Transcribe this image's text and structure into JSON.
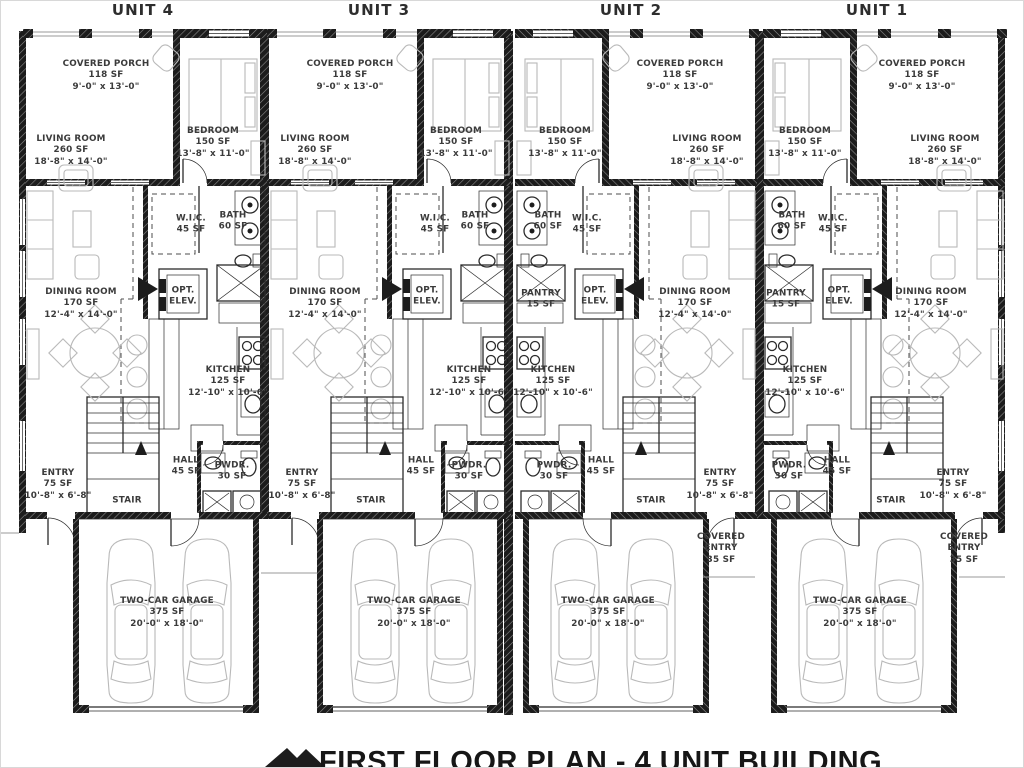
{
  "plan_title": "FIRST FLOOR PLAN - 4 UNIT BUILDING",
  "units": [
    {
      "name": "UNIT 4"
    },
    {
      "name": "UNIT 3"
    },
    {
      "name": "UNIT 2"
    },
    {
      "name": "UNIT 1"
    }
  ],
  "rooms": {
    "covered_porch": "COVERED PORCH\n118 SF\n9'-0\" x 13'-0\"",
    "living_room": "LIVING ROOM\n260 SF\n18'-8\" x 14'-0\"",
    "bedroom": "BEDROOM\n150 SF\n13'-8\" x 11'-0\"",
    "wic": "W.I.C.\n45 SF",
    "bath": "BATH\n60 SF",
    "opt_elev": "OPT.\nELEV.",
    "dining_room": "DINING ROOM\n170 SF\n12'-4\" x 14'-0\"",
    "kitchen": "KITCHEN\n125 SF\n12'-10\" x 10'-6\"",
    "pantry": "PANTRY\n15 SF",
    "hall": "HALL\n45 SF",
    "pwdr": "PWDR.\n30 SF",
    "entry": "ENTRY\n75 SF\n10'-8\" x 6'-8\"",
    "stair": "STAIR",
    "garage": "TWO-CAR GARAGE\n375 SF\n20'-0\" x 18'-0\"",
    "covered_entry": "COVERED\nENTRY\n35 SF"
  },
  "colors": {
    "wall": "#1c1c1c",
    "furniture": "#b9b9b9",
    "label": "#3b3b3b"
  }
}
